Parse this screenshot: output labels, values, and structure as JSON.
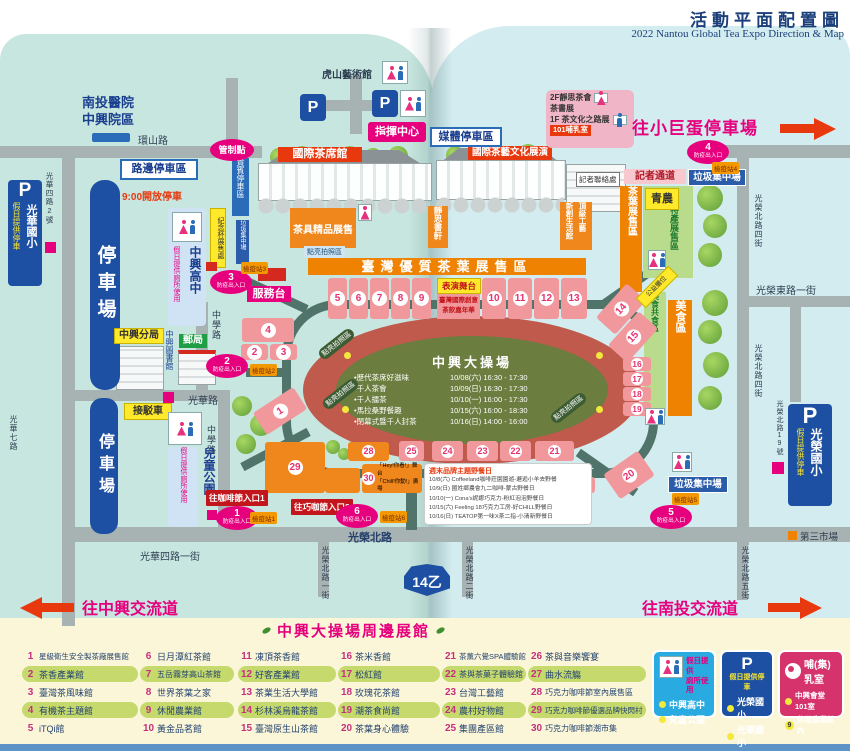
{
  "title": {
    "zh": "活動平面配置圖",
    "en": "2022 Nantou Global Tea Expo Direction & Map"
  },
  "labels": {
    "hospital1": "南投醫院",
    "hospital2": "中興院區",
    "huanshan_rd": "環山路",
    "roadside_parking": "路邊停車區",
    "open_930": "9:00開放停車",
    "control_point": "管制點",
    "vip_parking": "貴賓停車區",
    "trash": "垃圾集中場",
    "tiger_hill": "虎山藝術館",
    "command_center": "指揮中心",
    "media_parking": "媒體停車區",
    "intl_tea_hall": "國際茶席館",
    "tea_culture_show": "國際茶藝文化展演",
    "teaware_sale": "茶具精品展售",
    "photo_spot": "點亮拍照區",
    "jingsi_shop": "靜思書軒",
    "new_life_hall": "新創生活館",
    "top_craft": "頂級工藝",
    "f2_line1": "2F靜思茶會",
    "f2_line2": "茶書展",
    "f1_line": "1F 茶文化之路展",
    "nursing_101": "101哺乳室",
    "press_contact": "記者聯絡處",
    "press_way": "記者通道",
    "young_farmer": "青農",
    "tea_sale_strip": "茶葉展售區",
    "agri_strip": "農特產展售區",
    "food_share_strip": "美食共食區",
    "food_strip": "美食區",
    "charity_booth": "公益攤位",
    "tea_banner": "臺灣優質茶葉展售區",
    "stage": "表演舞台",
    "teadrink1": "臺灣國際創意",
    "teadrink2": "茶飲嘉年華",
    "parking_lot": "停車場",
    "shuttle": "接駁車",
    "zhongxing_high": "中興高中",
    "holiday_toilet": "假日提供廁所使用",
    "memorial_cup": "紀念杯展售處",
    "service_desk": "服務台",
    "police": "中興分局",
    "library": "中興圖書館",
    "post_office": "郵局",
    "children_park": "兒童公園",
    "coffee_entry1": "往咖啡節入口1",
    "choco_entry2": "往巧咖節入口2",
    "third_market": "第三市場",
    "p": "P",
    "guanghua_es": "光華國小",
    "guangrong_es": "光榮國小",
    "holiday_parking": "假日提供停車",
    "hey_line1": "「Hey!你看!」舞台",
    "hey_line2": "「Chill!你動!」廣場"
  },
  "roads": {
    "guanghua_rd": "光華路",
    "guanghua4_no2": "光華四路2號",
    "guanghua7": "光華七路",
    "zhongxue_rd": "中學路",
    "guanghua4_1st": "光華四路一街",
    "guangrong_n": "光榮北路",
    "guangrong_n1": "光榮北路一街",
    "guangrong_n2": "光榮北路二街",
    "guangrong_n4": "光榮北路四街",
    "guangrong_n5": "光榮北路五街",
    "guangrong_e1": "光榮東路一街",
    "guangrong_no19": "光榮北路19號",
    "hwy": "14乙"
  },
  "arrows": {
    "to_dome": "往小巨蛋停車場",
    "to_zhongxing_ic": "往中興交流道",
    "to_nantou_ic": "往南投交流道"
  },
  "entrances": {
    "label": "防疫出入口",
    "nums": [
      "1",
      "2",
      "3",
      "4",
      "5",
      "6"
    ],
    "stations": [
      "檢疫站1",
      "檢疫站2",
      "檢疫站3",
      "檢疫站4",
      "檢疫站5",
      "檢疫站6"
    ]
  },
  "stadium": {
    "title": "中興大操場",
    "events": [
      {
        "n": "歷代茶席好滋味",
        "t": "10/08(六) 16:30 - 17:30"
      },
      {
        "n": "千人茶會",
        "t": "10/09(日) 16:30 - 17:30"
      },
      {
        "n": "千人擂茶",
        "t": "10/10(一) 16:00 - 17:30"
      },
      {
        "n": "馬拉桑野餐趣",
        "t": "10/15(六) 16:00 - 18:30"
      },
      {
        "n": "閉幕式暨千人封茶",
        "t": "10/16(日) 14:00 - 16:00"
      }
    ]
  },
  "picnic": {
    "title": "週末品牌主題野餐日",
    "lines": [
      "10/8(六) Coffeeland咖啡莊園園遊-邂逅小羊去野餐",
      "10/9(日) 國姓鄉農會九二咖啡-蒙古野餐日",
      "10/10(一) Cona's妮娜巧克力-粉紅泡泡野餐日",
      "10/15(六) Feeling 18巧克力工房-好CHILL野餐日",
      "10/16(日) TEATOP第一味X茶二指-小清新野餐日"
    ]
  },
  "legend": {
    "title": "中興大操場周邊展館",
    "items": [
      {
        "num": "1",
        "label": "星級衛生安全製茶廠展售館"
      },
      {
        "num": "2",
        "label": "茶香產業館"
      },
      {
        "num": "3",
        "label": "臺灣茶風味館"
      },
      {
        "num": "4",
        "label": "有機茶主題館"
      },
      {
        "num": "5",
        "label": "iTQi館"
      },
      {
        "num": "6",
        "label": "日月潭紅茶館"
      },
      {
        "num": "7",
        "label": "五岳霧芽高山茶館"
      },
      {
        "num": "8",
        "label": "世界茶葉之家"
      },
      {
        "num": "9",
        "label": "休閒農業館"
      },
      {
        "num": "10",
        "label": "黃金品茗館"
      },
      {
        "num": "11",
        "label": "凍頂茶香館"
      },
      {
        "num": "12",
        "label": "好客產業館"
      },
      {
        "num": "13",
        "label": "茶業生活大學館"
      },
      {
        "num": "14",
        "label": "杉林溪烏龍茶館"
      },
      {
        "num": "15",
        "label": "臺灣原生山茶館"
      },
      {
        "num": "16",
        "label": "茶米香館"
      },
      {
        "num": "17",
        "label": "松紅館"
      },
      {
        "num": "18",
        "label": "玫瑰花茶館"
      },
      {
        "num": "19",
        "label": "潮茶食尚館"
      },
      {
        "num": "20",
        "label": "茶葉身心體驗"
      },
      {
        "num": "21",
        "label": "茶薰六覺SPA體驗館"
      },
      {
        "num": "22",
        "label": "茶與茶菓子體驗館"
      },
      {
        "num": "23",
        "label": "台灣工藝館"
      },
      {
        "num": "24",
        "label": "農村好物館"
      },
      {
        "num": "25",
        "label": "集團產區館"
      },
      {
        "num": "26",
        "label": "茶與音樂饗宴"
      },
      {
        "num": "27",
        "label": "曲水流觴"
      },
      {
        "num": "28",
        "label": "巧克力咖啡節室內展售區"
      },
      {
        "num": "29",
        "label": "巧克力咖啡節優選品牌快閃村"
      },
      {
        "num": "30",
        "label": "巧克力咖啡節潮市集"
      }
    ]
  },
  "info": {
    "toilet": {
      "line1": "假日提供",
      "line2": "廁所使用",
      "item1": "中興高中",
      "item2": "兒童公園"
    },
    "parking": {
      "p": "P",
      "title": "假日提供停車",
      "item1": "光榮國小",
      "item2": "光華國小"
    },
    "nursing": {
      "title": "哺(集)乳室",
      "item1": "中興會堂101室",
      "badge": "9",
      "item2": "休閒農業館內"
    }
  }
}
